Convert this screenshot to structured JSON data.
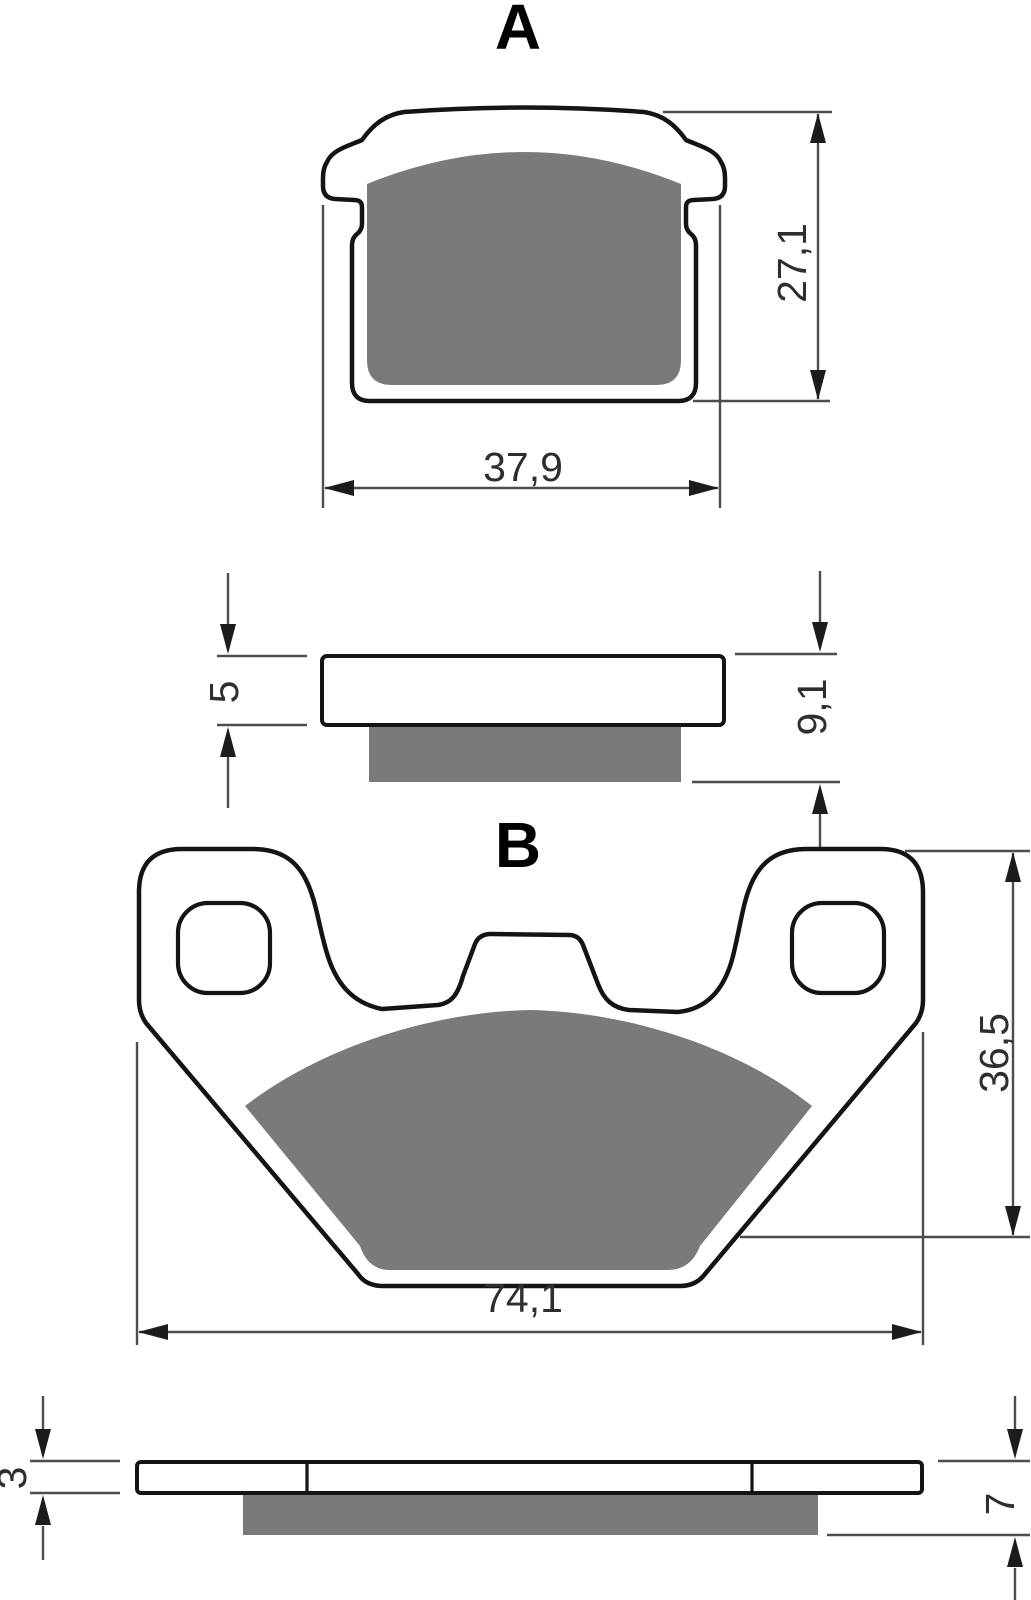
{
  "colors": {
    "background": "#ffffff",
    "outline": "#141414",
    "friction": "#7a7a7a",
    "dimension_line": "#4d4d4d",
    "arrow": "#1c1c1c",
    "text": "#2e2e2e"
  },
  "views": {
    "front_a": {
      "label": "A",
      "height": "27,1",
      "width": "37,9"
    },
    "side_a": {
      "backing_thickness": "5",
      "total_thickness": "9,1"
    },
    "front_b": {
      "label": "B",
      "height": "36,5",
      "width": "74,1"
    },
    "side_b": {
      "backing_thickness": "3",
      "total_thickness": "7"
    }
  }
}
